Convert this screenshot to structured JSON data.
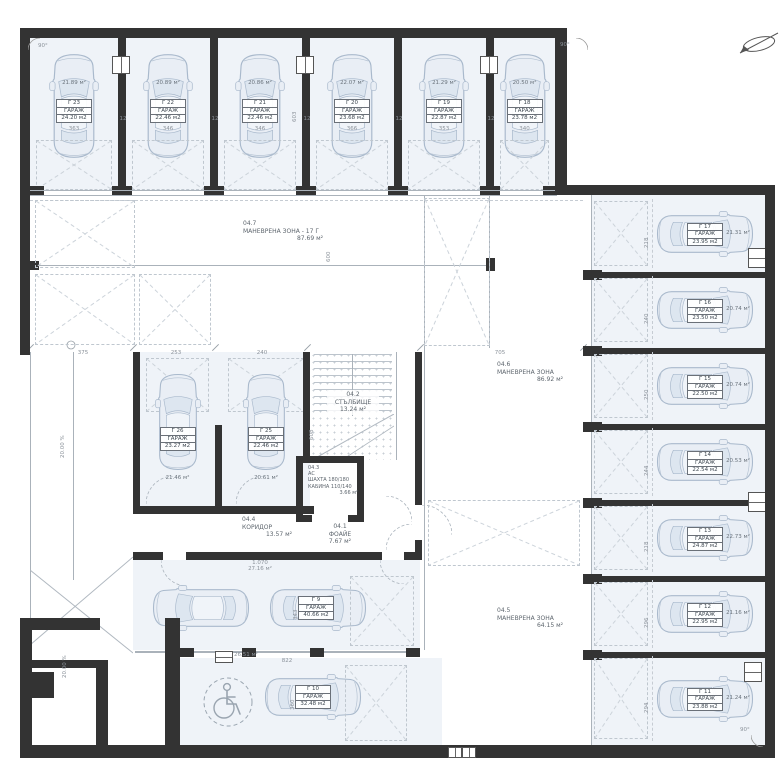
{
  "zones": {
    "z47": {
      "code": "04.7",
      "name": "МАНЕВРЕНА ЗОНА - 17 Г",
      "area": "87.69 м²"
    },
    "z46": {
      "code": "04.6",
      "name": "МАНЕВРЕНА ЗОНА",
      "area": "86.92 м²"
    },
    "z45": {
      "code": "04.5",
      "name": "МАНЕВРЕНА ЗОНА",
      "area": "64.15 м²"
    },
    "stair": {
      "code": "04.2",
      "name": "СТЪЛБИЩЕ",
      "area": "13.24 м²"
    },
    "elevator": {
      "code": "04.3",
      "name": "АС",
      "line1": "ШАХТА 180/180",
      "line2": "КАБИНА 110/140",
      "area": "3.66 м²"
    },
    "corridor": {
      "code": "04.4",
      "name": "КОРИДОР",
      "area": "13.57 м²"
    },
    "foyer": {
      "code": "04.1",
      "name": "ФОАЙЕ",
      "area": "7.67 м²"
    }
  },
  "garages": {
    "top": [
      {
        "id": "Г 23",
        "type": "ГАРАЖ",
        "area": "24.20 м2",
        "free": "21.89 м²",
        "dim": "363"
      },
      {
        "id": "Г 22",
        "type": "ГАРАЖ",
        "area": "22.46 м2",
        "free": "20.89 м²",
        "dim": "346"
      },
      {
        "id": "Г 21",
        "type": "ГАРАЖ",
        "area": "22.46 м2",
        "free": "20.86 м²",
        "dim": "346"
      },
      {
        "id": "Г 20",
        "type": "ГАРАЖ",
        "area": "23.68 м2",
        "free": "22.07 м²",
        "dim": "366"
      },
      {
        "id": "Г 19",
        "type": "ГАРАЖ",
        "area": "22.87 м2",
        "free": "21.29 м²",
        "dim": "353"
      },
      {
        "id": "Г 18",
        "type": "ГАРАЖ",
        "area": "23.78 м2",
        "free": "20.50 м²",
        "dim": "340"
      }
    ],
    "right": [
      {
        "id": "Г 17",
        "type": "ГАРАЖ",
        "area": "23.95 м2",
        "free": "21.31 м²",
        "dim": "218"
      },
      {
        "id": "Г 16",
        "type": "ГАРАЖ",
        "area": "23.50 м2",
        "free": "20.74 м²",
        "dim": "240"
      },
      {
        "id": "Г 15",
        "type": "ГАРАЖ",
        "area": "22.50 м2",
        "free": "20.74 м²",
        "dim": "250"
      },
      {
        "id": "Г 14",
        "type": "ГАРАЖ",
        "area": "22.54 м2",
        "free": "20.53 м²",
        "dim": "244"
      },
      {
        "id": "Г 13",
        "type": "ГАРАЖ",
        "area": "24.87 м2",
        "free": "22.73 м²",
        "dim": "218"
      },
      {
        "id": "Г 12",
        "type": "ГАРАЖ",
        "area": "22.95 м2",
        "free": "21.16 м²",
        "dim": "296"
      },
      {
        "id": "Г 11",
        "type": "ГАРАЖ",
        "area": "23.88 м2",
        "free": "21.24 м²",
        "dim": "294"
      }
    ],
    "mid": [
      {
        "id": "Г 26",
        "type": "ГАРАЖ",
        "area": "23.27 м2",
        "free": "21.46 м²",
        "dim": "253"
      },
      {
        "id": "Г 25",
        "type": "ГАРАЖ",
        "area": "22.46 м2",
        "free": "20.61 м²",
        "dim": "240"
      }
    ],
    "bottom": [
      {
        "id": "Г 9",
        "type": "ГАРАЖ",
        "area": "40.66 м2",
        "dim": "343"
      },
      {
        "id": "Г 10",
        "type": "ГАРАЖ",
        "area": "32.48 м2",
        "dim": "360"
      }
    ]
  },
  "annotations": {
    "angle_top_left": "90°",
    "angle_top_right": "90°",
    "angle_bottom_right": "90°",
    "slope_upper": "20.00 %",
    "slope_lower": "20.00 %",
    "dim_ramp": "375",
    "dim_g26": "253",
    "dim_g25": "240",
    "dim_center": "705",
    "dim_depth_top": "603",
    "dim_line_600": "600",
    "dim_depth_stair": "608",
    "dim_bottom_opening": "822",
    "dim_car_lane": "1.070",
    "area_lane": "27.16 м²",
    "area_small": "26.51 м²",
    "wall_thickness": "12"
  }
}
